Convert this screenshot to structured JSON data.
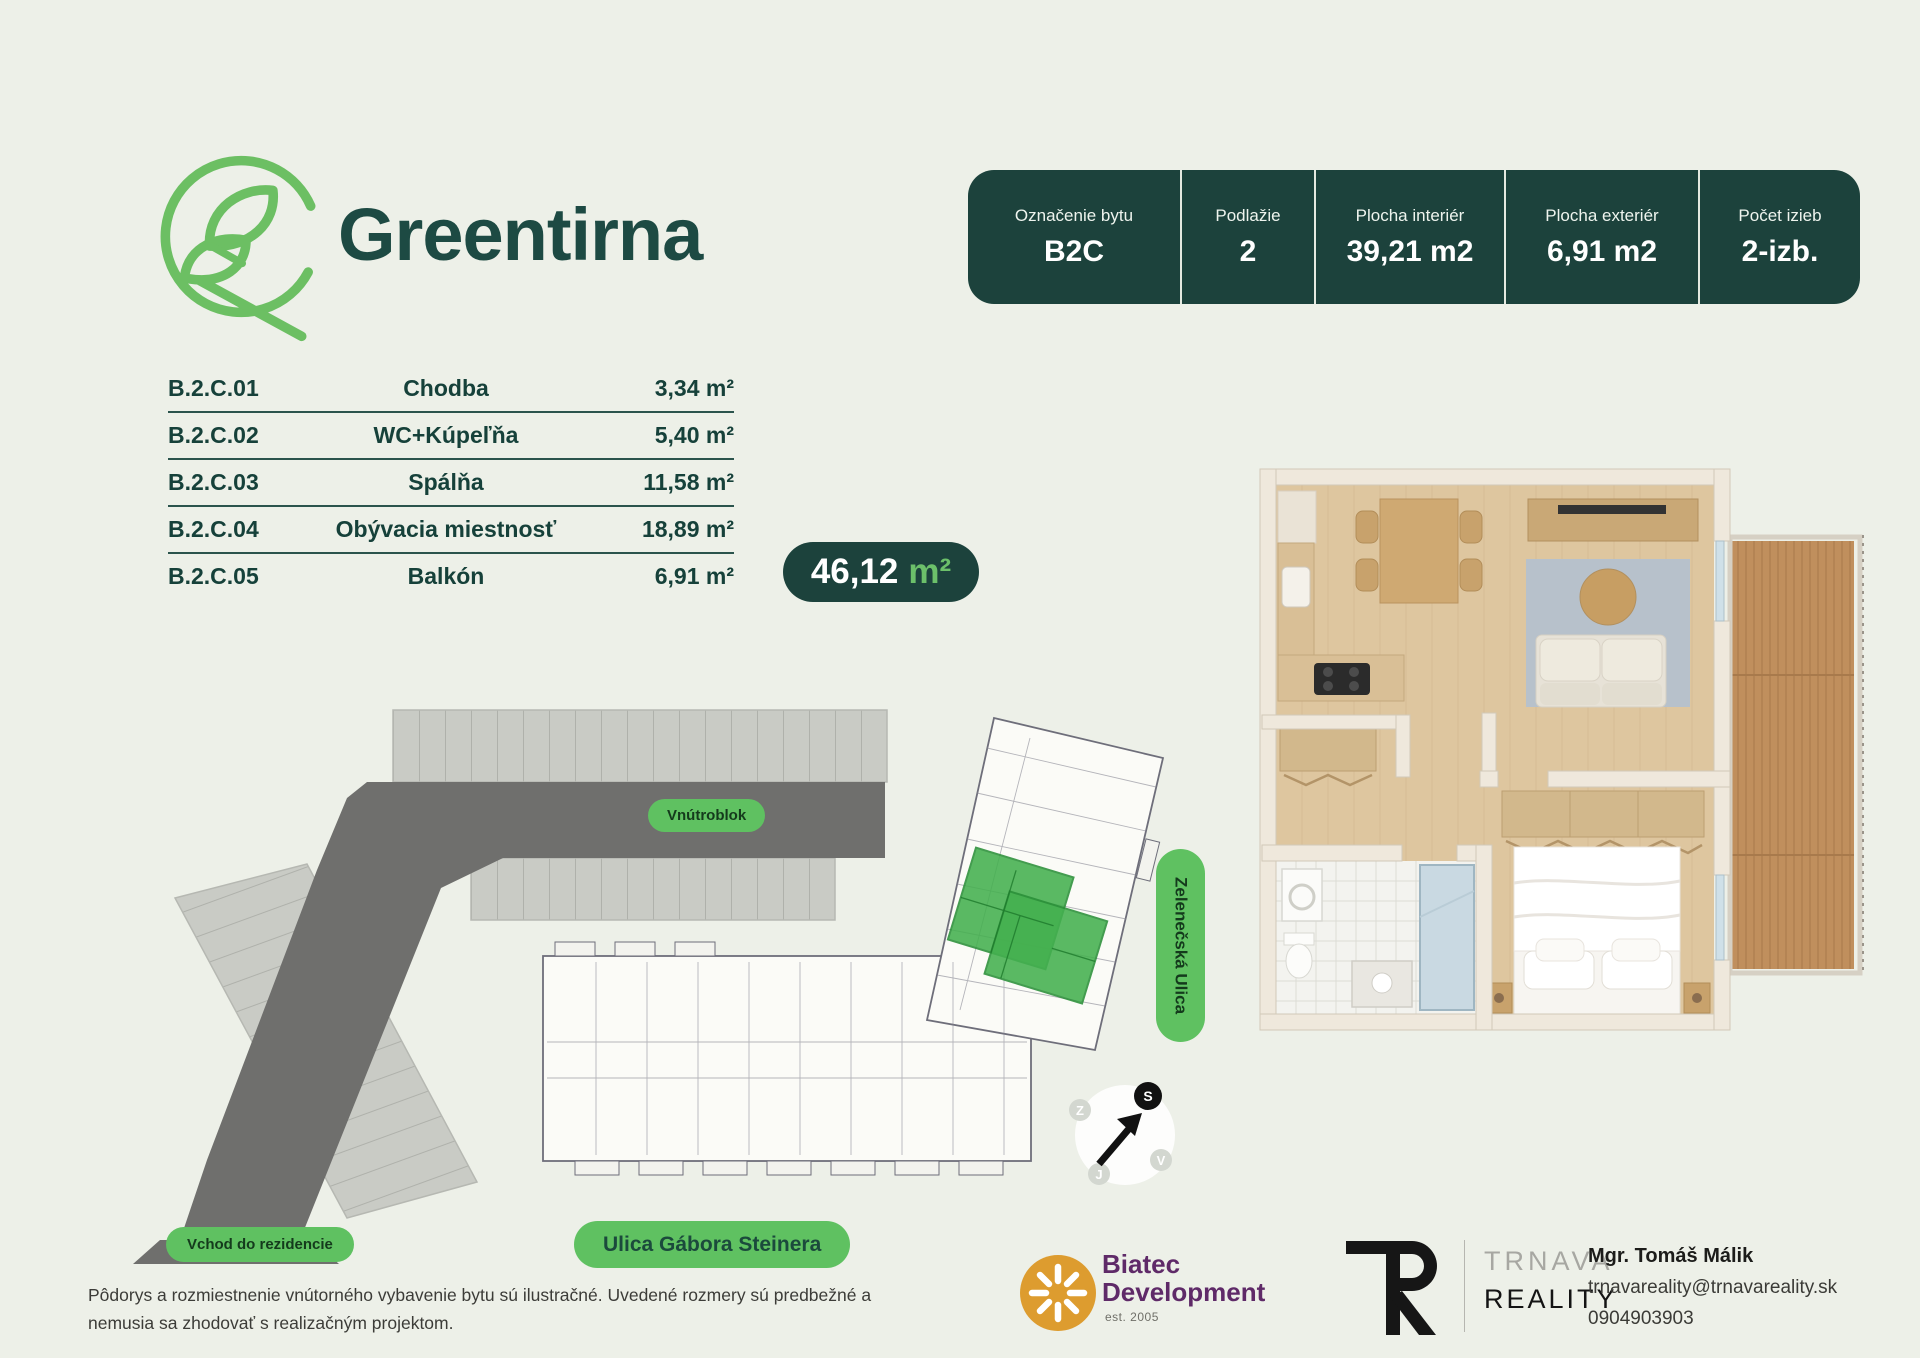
{
  "brand": {
    "name": "Greentirna"
  },
  "info_table": {
    "columns": [
      {
        "label": "Označenie bytu",
        "value": "B2C"
      },
      {
        "label": "Podlažie",
        "value": "2"
      },
      {
        "label": "Plocha interiér",
        "value": "39,21 m2"
      },
      {
        "label": "Plocha exteriér",
        "value": "6,91 m2"
      },
      {
        "label": "Počet izieb",
        "value": "2-izb."
      }
    ]
  },
  "rooms": {
    "rows": [
      {
        "code": "B.2.C.01",
        "name": "Chodba",
        "area": "3,34 m²"
      },
      {
        "code": "B.2.C.02",
        "name": "WC+Kúpeľňa",
        "area": "5,40 m²"
      },
      {
        "code": "B.2.C.03",
        "name": "Spálňa",
        "area": "11,58 m²"
      },
      {
        "code": "B.2.C.04",
        "name": "Obývacia miestnosť",
        "area": "18,89 m²"
      },
      {
        "code": "B.2.C.05",
        "name": "Balkón",
        "area": "6,91 m²"
      }
    ]
  },
  "total": {
    "value": "46,12",
    "unit": "m²"
  },
  "site_plan": {
    "labels": {
      "vnutroblok": "Vnútroblok",
      "vchod": "Vchod do rezidencie",
      "ulica_gabora": "Ulica Gábora Steinera",
      "zelenecka": "Zelenečská Ulica"
    },
    "compass": {
      "north": "S",
      "west": "Z",
      "east": "V",
      "south": "J"
    }
  },
  "footer": {
    "disclaimer": "Pôdorys a rozmiestnenie vnútorného vybavenie bytu sú ilustračné. Uvedené rozmery sú predbežné a nemusia sa zhodovať s realizačným projektom.",
    "biatec": {
      "line1": "Biatec",
      "line2": "Development",
      "est": "est. 2005"
    },
    "trnava": {
      "line1": "TRNAVA",
      "line2": "REALITY"
    },
    "contact": {
      "name": "Mgr. Tomáš Málik",
      "email": "trnavareality@trnavareality.sk",
      "phone": "0904903903"
    }
  },
  "colors": {
    "accent_green": "#5fc161",
    "dark_teal": "#1c423c",
    "unit_highlight": "#44b04f"
  }
}
